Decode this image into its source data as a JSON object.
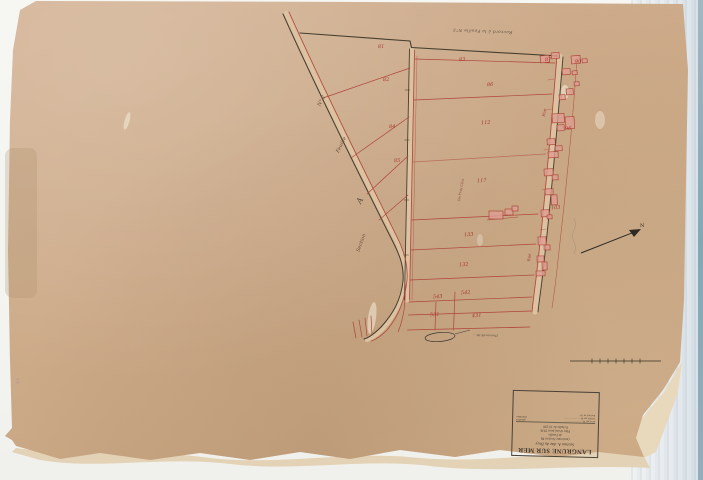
{
  "scan": {
    "description": "Scanned cadastral plan sheet on scanner background",
    "paper_color": "#cdab89",
    "ink_red": "#b0453a",
    "ink_black": "#3f382c",
    "building_fill": "#df9d91"
  },
  "cartouche": {
    "title": "LANGRUNE SUR MER",
    "subtitle": "Section A. dite du Bray",
    "ancienne": "(ancienne Section D)",
    "feuille": "4e Feuille",
    "revision": "Plan révisé pour 1936",
    "echelle": "Échelle de 1/1250",
    "table_rows": [
      {
        "leader": "Levé par M. ····················",
        "role": "géomètre"
      },
      {
        "leader": "Vérifié par M. ··················",
        "role": "contrôleur"
      },
      {
        "leader": "Exécuté en 19··",
        "role": ""
      }
    ]
  },
  "labels": {
    "raccord_top": "Raccord à la Feuille N°3",
    "section": "Section",
    "section_letter": "A",
    "feuille": "Feuille",
    "feuille_no": "N°.2",
    "lieu_dit": "De Prés Clos",
    "rue_top": "Rue",
    "rue_mid": "Rue",
    "north_letter": "N",
    "chemin_vertical": "Chemin",
    "junction_note": "Chemin dit de …",
    "margin_stamp": "48"
  },
  "parcels": [
    {
      "label": "81",
      "x": 378,
      "y": 44
    },
    {
      "label": "82",
      "x": 383,
      "y": 77
    },
    {
      "label": "84",
      "x": 389,
      "y": 124
    },
    {
      "label": "85",
      "x": 394,
      "y": 158
    },
    {
      "label": "83",
      "x": 459,
      "y": 57
    },
    {
      "label": "86",
      "x": 487,
      "y": 82
    },
    {
      "label": "112",
      "x": 481,
      "y": 120
    },
    {
      "label": "117",
      "x": 477,
      "y": 178
    },
    {
      "label": "133",
      "x": 464,
      "y": 232
    },
    {
      "label": "132",
      "x": 459,
      "y": 262
    },
    {
      "label": "543",
      "x": 433,
      "y": 294
    },
    {
      "label": "542",
      "x": 461,
      "y": 290
    },
    {
      "label": "531",
      "x": 430,
      "y": 312
    },
    {
      "label": "431",
      "x": 472,
      "y": 313
    },
    {
      "label": "87",
      "x": 545,
      "y": 57
    },
    {
      "label": "90",
      "x": 575,
      "y": 59
    },
    {
      "label": "96",
      "x": 565,
      "y": 126
    },
    {
      "label": "103",
      "x": 551,
      "y": 205
    }
  ],
  "buildings": [
    {
      "x": 540,
      "y": 56,
      "w": 9,
      "h": 7,
      "r": -6
    },
    {
      "x": 551,
      "y": 53,
      "w": 8,
      "h": 6,
      "r": -6
    },
    {
      "x": 571,
      "y": 56,
      "w": 9,
      "h": 8,
      "r": -4
    },
    {
      "x": 582,
      "y": 59,
      "w": 5,
      "h": 4,
      "r": -4
    },
    {
      "x": 562,
      "y": 69,
      "w": 8,
      "h": 6,
      "r": -4
    },
    {
      "x": 572,
      "y": 71,
      "w": 5,
      "h": 4,
      "r": -4
    },
    {
      "x": 574,
      "y": 82,
      "w": 5,
      "h": 4,
      "r": -4
    },
    {
      "x": 566,
      "y": 89,
      "w": 7,
      "h": 6,
      "r": -4
    },
    {
      "x": 559,
      "y": 95,
      "w": 6,
      "h": 5,
      "r": -4
    },
    {
      "x": 552,
      "y": 114,
      "w": 12,
      "h": 9,
      "r": -3
    },
    {
      "x": 565,
      "y": 117,
      "w": 9,
      "h": 12,
      "r": -3
    },
    {
      "x": 557,
      "y": 125,
      "w": 7,
      "h": 6,
      "r": -3
    },
    {
      "x": 547,
      "y": 139,
      "w": 8,
      "h": 6,
      "r": -3
    },
    {
      "x": 555,
      "y": 146,
      "w": 7,
      "h": 5,
      "r": -3
    },
    {
      "x": 548,
      "y": 152,
      "w": 10,
      "h": 6,
      "r": -3
    },
    {
      "x": 544,
      "y": 169,
      "w": 9,
      "h": 7,
      "r": -2
    },
    {
      "x": 552,
      "y": 175,
      "w": 6,
      "h": 5,
      "r": -2
    },
    {
      "x": 545,
      "y": 189,
      "w": 8,
      "h": 6,
      "r": -2
    },
    {
      "x": 551,
      "y": 195,
      "w": 6,
      "h": 10,
      "r": -2
    },
    {
      "x": 541,
      "y": 210,
      "w": 8,
      "h": 7,
      "r": -2
    },
    {
      "x": 547,
      "y": 215,
      "w": 5,
      "h": 4,
      "r": -2
    },
    {
      "x": 538,
      "y": 237,
      "w": 8,
      "h": 8,
      "r": -1
    },
    {
      "x": 544,
      "y": 245,
      "w": 6,
      "h": 5,
      "r": -1
    },
    {
      "x": 537,
      "y": 256,
      "w": 7,
      "h": 6,
      "r": -1
    },
    {
      "x": 542,
      "y": 262,
      "w": 5,
      "h": 8,
      "r": -1
    },
    {
      "x": 536,
      "y": 271,
      "w": 9,
      "h": 5,
      "r": -1
    },
    {
      "x": 489,
      "y": 211,
      "w": 14,
      "h": 8,
      "r": 0
    },
    {
      "x": 505,
      "y": 209,
      "w": 8,
      "h": 6,
      "r": 0
    },
    {
      "x": 512,
      "y": 206,
      "w": 6,
      "h": 5,
      "r": 0
    }
  ]
}
